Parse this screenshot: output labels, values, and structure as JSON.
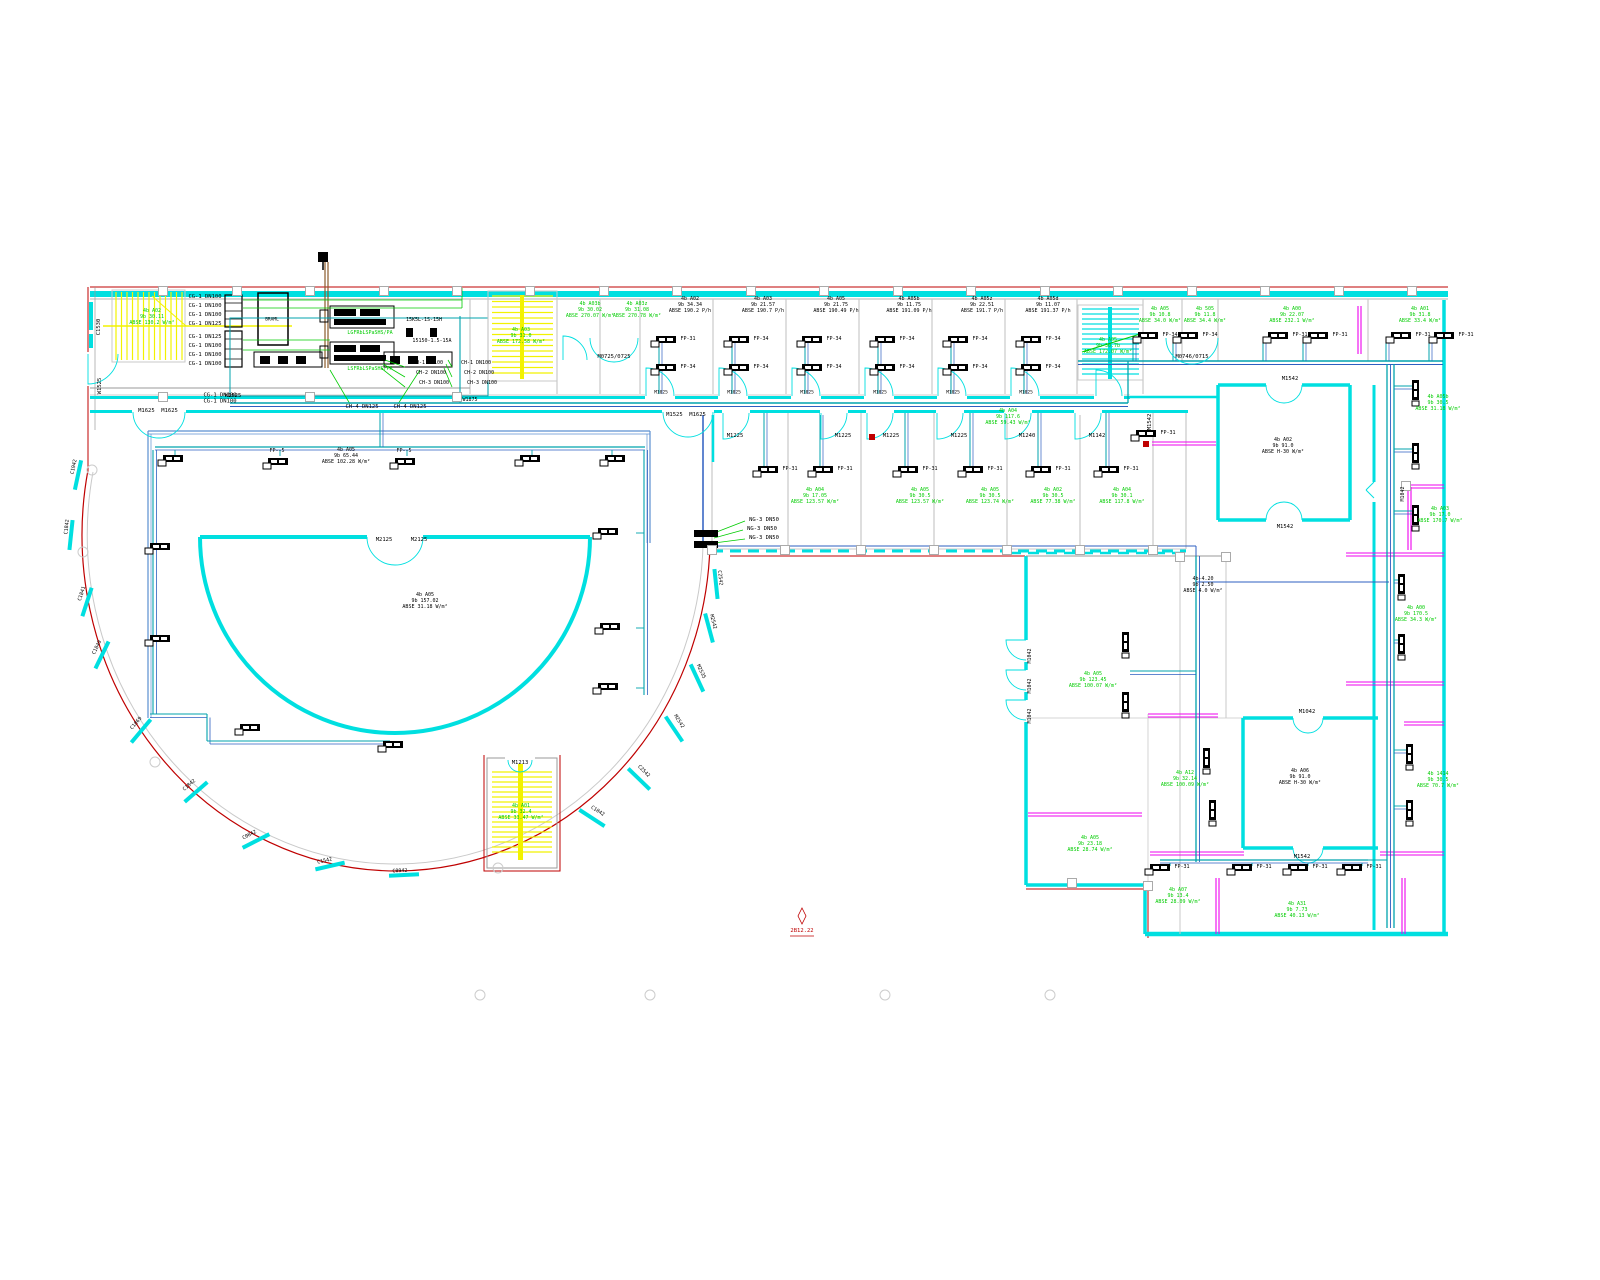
{
  "palette": {
    "black": "#000000",
    "green": "#00cc00",
    "red": "#bf0000",
    "cyan": "#00dfe0",
    "teal": "#00a3ad",
    "blue": "#2d5fc0",
    "gray": "#c9c9c9",
    "darkgray": "#9a9a9a",
    "magenta": "#ef00ef",
    "yellow": "#f2f200",
    "brown": "#8a5a2a"
  },
  "drawing": {
    "labels": [
      [
        "C1530",
        99,
        327,
        "k",
        -90,
        5.5
      ],
      [
        "4b A02\n9b 30.11\nABSE 130.2 W/m²",
        152,
        318,
        "g",
        0,
        5
      ],
      [
        "CG-1 DN100",
        205,
        297,
        "k",
        0,
        5.5
      ],
      [
        "CG-1 DN100",
        205,
        306,
        "k",
        0,
        5.5
      ],
      [
        "CG-1 DN100",
        205,
        315,
        "k",
        0,
        5.5
      ],
      [
        "CG-1 DN125",
        205,
        324,
        "k",
        0,
        5.5
      ],
      [
        "CG-1 DN125",
        205,
        337,
        "k",
        0,
        5.5
      ],
      [
        "CG-1 DN100",
        205,
        346,
        "k",
        0,
        5.5
      ],
      [
        "CG-1 DN100",
        205,
        355,
        "k",
        0,
        5.5
      ],
      [
        "CG-1 DN100",
        205,
        364,
        "k",
        0,
        5.5
      ],
      [
        "CG-1 DN100\nCG-1 DN100",
        220,
        399,
        "k",
        0,
        5.5
      ],
      [
        "M1625  M1625",
        158,
        411,
        "k",
        0,
        5.5
      ],
      [
        "W1525",
        100,
        386,
        "k",
        -90,
        5.5
      ],
      [
        "W1525",
        233,
        396,
        "k",
        0,
        5.5
      ],
      [
        "BRAML",
        272,
        320,
        "k",
        0,
        4.5
      ],
      [
        "LGFRbLSPaSHS/PA",
        370,
        334,
        "g",
        0,
        5
      ],
      [
        "LSFRbLSPaSHS/PA",
        370,
        370,
        "g",
        0,
        5
      ],
      [
        "15K5L-1S-15H",
        424,
        321,
        "k",
        0,
        5
      ],
      [
        "15150-1.5-15A",
        432,
        342,
        "k",
        0,
        5
      ],
      [
        "CH-1 DN100",
        428,
        364,
        "k",
        0,
        5
      ],
      [
        "CH-2 DN100",
        431,
        374,
        "k",
        0,
        5
      ],
      [
        "CH-3 DN100",
        434,
        384,
        "k",
        0,
        5
      ],
      [
        "CH-1 DN100",
        476,
        364,
        "k",
        0,
        5
      ],
      [
        "CH-2 DN100",
        479,
        374,
        "k",
        0,
        5
      ],
      [
        "CH-3 DN100",
        482,
        384,
        "k",
        0,
        5
      ],
      [
        "CH-4 DN125",
        362,
        407,
        "k",
        0,
        5.5
      ],
      [
        "CH-4 DN125",
        410,
        407,
        "k",
        0,
        5.5
      ],
      [
        "W1875",
        470,
        401,
        "k",
        0,
        5
      ],
      [
        "4b A03\n9b 31.0\nABSE 172.58 W/m²",
        521,
        337,
        "g",
        0,
        5
      ],
      [
        "4b A03b\n9b 30.02\nABSE 270.07 W/m²",
        590,
        311,
        "g",
        0,
        5
      ],
      [
        "4b A03z\n9b 31.08\nABSE 270.78 W/m²",
        637,
        311,
        "g",
        0,
        5
      ],
      [
        "M0725/0725",
        614,
        357,
        "k",
        0,
        5.5
      ],
      [
        "4b A02\n9b 34.34\nABSE 190.2 P/h",
        690,
        306,
        "k",
        0,
        5
      ],
      [
        "4b A03\n9b 21.57\nABSE 190.7 P/h",
        763,
        306,
        "k",
        0,
        5
      ],
      [
        "4b A05\n9b 21.75\nABSE 190.49 P/h",
        836,
        306,
        "k",
        0,
        5
      ],
      [
        "4b A05b\n9b 11.75\nABSE 191.09 P/h",
        909,
        306,
        "k",
        0,
        5
      ],
      [
        "4b A05z\n9b 22.51\nABSE 191.7 P/h",
        982,
        306,
        "k",
        0,
        5
      ],
      [
        "4b A05d\n9b 11.07\nABSE 191.37 P/h",
        1048,
        306,
        "k",
        0,
        5
      ],
      [
        "M1025",
        661,
        393,
        "k",
        0,
        4.5
      ],
      [
        "M1025",
        734,
        393,
        "k",
        0,
        4.5
      ],
      [
        "M1025",
        807,
        393,
        "k",
        0,
        4.5
      ],
      [
        "M1025",
        880,
        393,
        "k",
        0,
        4.5
      ],
      [
        "M1025",
        953,
        393,
        "k",
        0,
        4.5
      ],
      [
        "M1025",
        1026,
        393,
        "k",
        0,
        4.5
      ],
      [
        "4b A05\n9b 30.7b\nABSE 172.07 W/m²",
        1108,
        347,
        "g",
        0,
        5
      ],
      [
        "4b A05\n9b 10.8\nABSE 34.0 W/m²",
        1160,
        316,
        "g",
        0,
        5
      ],
      [
        "4b 505\n9b 11.8\nABSE 34.4 W/m²",
        1205,
        316,
        "g",
        0,
        5
      ],
      [
        "4b A00\n9b 22.07\nABSE 232.1 W/m²",
        1292,
        316,
        "g",
        0,
        5
      ],
      [
        "4b A01\n9b 31.8\nABSE 33.4 W/m²",
        1420,
        316,
        "g",
        0,
        5
      ],
      [
        "M0746/0715",
        1192,
        357,
        "k",
        0,
        5.5
      ],
      [
        "M1542",
        1150,
        422,
        "k",
        -90,
        5.5
      ],
      [
        "M1542",
        1290,
        379,
        "k",
        0,
        5.5
      ],
      [
        "M1542",
        1285,
        527,
        "k",
        0,
        5.5
      ],
      [
        "4b A02\n9b 91.0\nABSE H-30 W/m²",
        1283,
        447,
        "k",
        0,
        5
      ],
      [
        "M1525  M1625",
        686,
        415,
        "k",
        0,
        5.5
      ],
      [
        "M1225",
        735,
        436,
        "k",
        0,
        5.5
      ],
      [
        "M1225",
        843,
        436,
        "k",
        0,
        5.5
      ],
      [
        "M1225",
        891,
        436,
        "k",
        0,
        5.5
      ],
      [
        "M1225",
        959,
        436,
        "k",
        0,
        5.5
      ],
      [
        "M1240",
        1027,
        436,
        "k",
        0,
        5.5
      ],
      [
        "M1142",
        1097,
        436,
        "k",
        0,
        5.5
      ],
      [
        "4b A04\n9b 117.6\nABSE 59.43 W/m²",
        1008,
        418,
        "g",
        0,
        5
      ],
      [
        "4b A04\n9b 17.05\nABSE 123.57 W/m²",
        815,
        497,
        "g",
        0,
        5
      ],
      [
        "4b A05\n9b 30.5\nABSE 123.57 W/m²",
        920,
        497,
        "g",
        0,
        5
      ],
      [
        "4b A05\n9b 30.5\nABSE 123.74 W/m²",
        990,
        497,
        "g",
        0,
        5
      ],
      [
        "4b A02\n9b 30.5\nABSE 77.38 W/m²",
        1053,
        497,
        "g",
        0,
        5
      ],
      [
        "4b A04\n9b 30.1\nABSE 117.8 W/m²",
        1122,
        497,
        "g",
        0,
        5
      ],
      [
        "NG-3 DN50",
        764,
        520,
        "k",
        0,
        5.5
      ],
      [
        "NG-3 DN50",
        762,
        529,
        "k",
        0,
        5.5
      ],
      [
        "NG-3 DN50",
        764,
        538,
        "k",
        0,
        5.5
      ],
      [
        "FP--5",
        277,
        452,
        "k",
        0,
        5
      ],
      [
        "FP--5",
        404,
        452,
        "k",
        0,
        5
      ],
      [
        "4b A05\n9b 65.44\nABSE 102.28 W/m²",
        346,
        457,
        "k",
        0,
        5
      ],
      [
        "M2125",
        384,
        540,
        "k",
        0,
        5.5
      ],
      [
        "M2125",
        419,
        540,
        "k",
        0,
        5.5
      ],
      [
        "4b A05\n9b 157.02\nABSE 31.18 W/m²",
        425,
        602,
        "k",
        0,
        5
      ],
      [
        "C1942",
        75,
        467,
        "k",
        -78,
        5
      ],
      [
        "C1842",
        68,
        527,
        "k",
        -84,
        5
      ],
      [
        "C1841",
        83,
        594,
        "k",
        -72,
        5
      ],
      [
        "C1840",
        98,
        648,
        "k",
        -64,
        5
      ],
      [
        "C1869",
        137,
        724,
        "k",
        -50,
        5
      ],
      [
        "C1842",
        190,
        786,
        "k",
        -41,
        5
      ],
      [
        "C0842",
        250,
        836,
        "k",
        -27,
        5
      ],
      [
        "C1542",
        325,
        862,
        "k",
        -13,
        5
      ],
      [
        "C0942",
        400,
        872,
        "k",
        -3,
        5
      ],
      [
        "C1842",
        597,
        812,
        "k",
        33,
        5
      ],
      [
        "C2542",
        643,
        772,
        "k",
        45,
        5
      ],
      [
        "M2542",
        678,
        722,
        "k",
        57,
        5
      ],
      [
        "M2535",
        700,
        672,
        "k",
        65,
        5
      ],
      [
        "M2542",
        712,
        622,
        "k",
        75,
        5
      ],
      [
        "C2542",
        719,
        578,
        "k",
        84,
        5
      ],
      [
        "M1213",
        520,
        763,
        "k",
        0,
        5.5
      ],
      [
        "4b A01\n9b 32.4\nABSE 33.47 W/m²",
        521,
        813,
        "g",
        0,
        5
      ],
      [
        "M1042",
        1031,
        656,
        "k",
        -90,
        5
      ],
      [
        "M1042",
        1031,
        686,
        "k",
        -90,
        5
      ],
      [
        "M1042",
        1031,
        716,
        "k",
        -90,
        5
      ],
      [
        "4b-4.20\n9b 2.50\nABSE 4.0 W/m²",
        1203,
        586,
        "k",
        0,
        5
      ],
      [
        "4b A05\n9b 123.45\nABSE 100.07 W/m²",
        1093,
        681,
        "g",
        0,
        5
      ],
      [
        "4b A05\n9b 23.18\nABSE 28.74 W/m²",
        1090,
        845,
        "g",
        0,
        5
      ],
      [
        "4b A12\n9b 32.14\nABSE 100.09 W/m²",
        1185,
        780,
        "g",
        0,
        5
      ],
      [
        "4b A06\n9b 91.0\nABSE H-30 W/m²",
        1300,
        778,
        "k",
        0,
        5
      ],
      [
        "M1042",
        1307,
        712,
        "k",
        0,
        5.5
      ],
      [
        "M1542",
        1302,
        857,
        "k",
        0,
        5.5
      ],
      [
        "4b A07\n9b 13.4\nABSE 28.09 W/m²",
        1178,
        897,
        "g",
        0,
        5
      ],
      [
        "4b A31\n9b 7.73\nABSE 40.13 W/m²",
        1297,
        911,
        "g",
        0,
        5
      ],
      [
        "4b A05b\n9b 30.5\nABSE 31.18 W/m²",
        1438,
        404,
        "g",
        0,
        5
      ],
      [
        "4b A03\n9b 17.0\nABSE 170.7 W/m²",
        1440,
        516,
        "g",
        0,
        5
      ],
      [
        "4b A00\n9b 170.5\nABSE 34.3 W/m²",
        1416,
        615,
        "g",
        0,
        5
      ],
      [
        "4b 1414\n9b 30.5\nABSE 70.7 W/m²",
        1438,
        781,
        "g",
        0,
        5
      ],
      [
        "M1042",
        1404,
        494,
        "k",
        -90,
        5
      ],
      [
        "2B12.22",
        802,
        931,
        "r",
        0,
        5.5
      ]
    ],
    "fp_horizontal": [
      [
        656,
        336,
        "FP-31"
      ],
      [
        656,
        364,
        "FP-34"
      ],
      [
        729,
        336,
        "FP-34"
      ],
      [
        729,
        364,
        "FP-34"
      ],
      [
        802,
        336,
        "FP-34"
      ],
      [
        802,
        364,
        "FP-34"
      ],
      [
        875,
        336,
        "FP-34"
      ],
      [
        875,
        364,
        "FP-34"
      ],
      [
        948,
        336,
        "FP-34"
      ],
      [
        948,
        364,
        "FP-34"
      ],
      [
        1021,
        336,
        "FP-34"
      ],
      [
        1021,
        364,
        "FP-34"
      ],
      [
        1138,
        332,
        "FP-34"
      ],
      [
        1178,
        332,
        "FP-34"
      ],
      [
        1268,
        332,
        "FP-31"
      ],
      [
        1308,
        332,
        "FP-31"
      ],
      [
        1391,
        332,
        "FP-31"
      ],
      [
        1434,
        332,
        "FP-31"
      ],
      [
        758,
        466,
        "FP-31"
      ],
      [
        813,
        466,
        "FP-31"
      ],
      [
        898,
        466,
        "FP-31"
      ],
      [
        963,
        466,
        "FP-31"
      ],
      [
        1031,
        466,
        "FP-31"
      ],
      [
        1099,
        466,
        "FP-31"
      ],
      [
        1136,
        430,
        "FP-31"
      ],
      [
        163,
        455,
        ""
      ],
      [
        268,
        458,
        ""
      ],
      [
        395,
        458,
        ""
      ],
      [
        520,
        455,
        ""
      ],
      [
        605,
        455,
        ""
      ],
      [
        150,
        543,
        ""
      ],
      [
        150,
        635,
        ""
      ],
      [
        240,
        724,
        ""
      ],
      [
        383,
        741,
        ""
      ],
      [
        598,
        528,
        ""
      ],
      [
        600,
        623,
        ""
      ],
      [
        598,
        683,
        ""
      ],
      [
        1150,
        864,
        "FP-31"
      ],
      [
        1232,
        864,
        "FP-31"
      ],
      [
        1288,
        864,
        "FP-31"
      ],
      [
        1342,
        864,
        "FP-31"
      ]
    ],
    "fp_vertical": [
      [
        1412,
        380
      ],
      [
        1412,
        443
      ],
      [
        1412,
        505
      ],
      [
        1398,
        574
      ],
      [
        1398,
        634
      ],
      [
        1406,
        744
      ],
      [
        1406,
        800
      ],
      [
        1122,
        632
      ],
      [
        1122,
        692
      ],
      [
        1203,
        748
      ],
      [
        1209,
        800
      ]
    ],
    "marker": {
      "elevation_text": "2B12.22"
    }
  }
}
